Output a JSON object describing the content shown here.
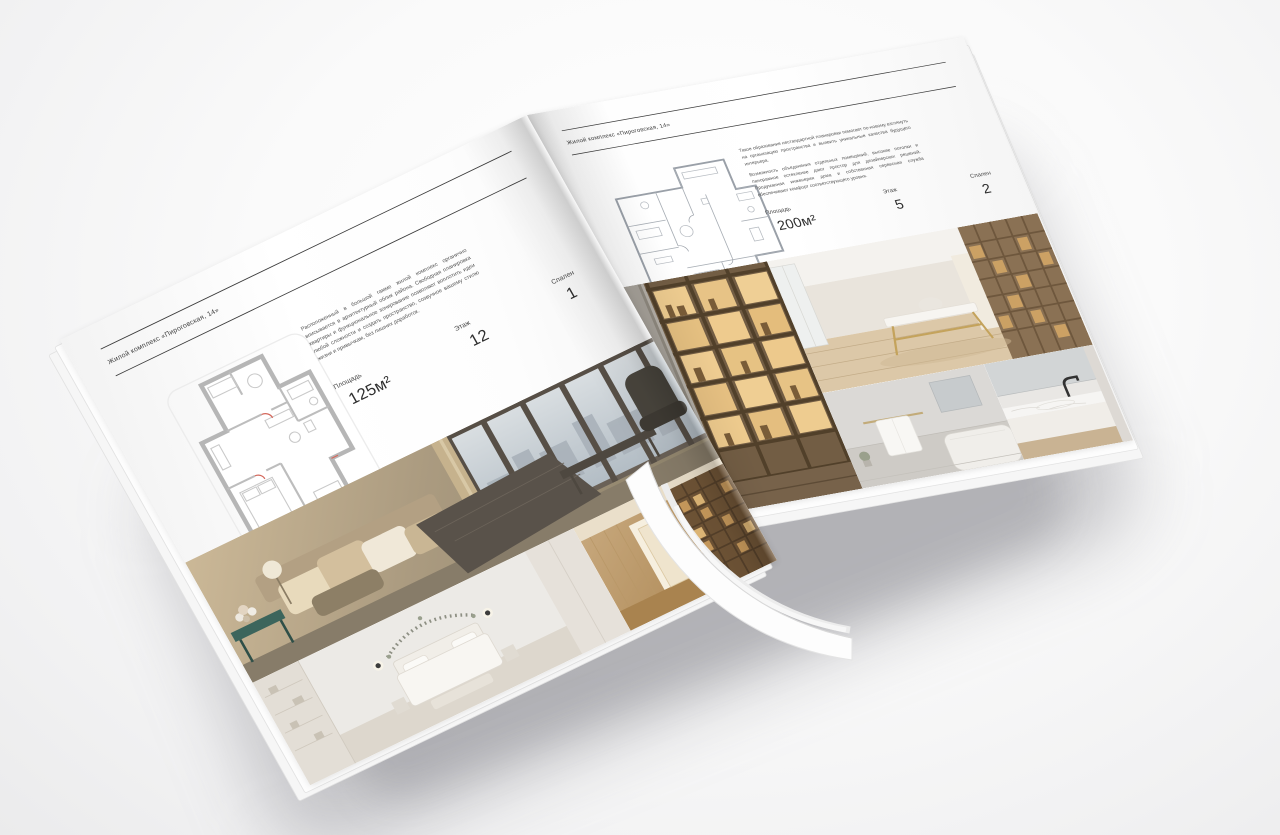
{
  "colors": {
    "background": "#f1f1f2",
    "paper": "#ffffff",
    "ink": "#3a3a3a"
  },
  "brochure": {
    "left_page": {
      "header": "Жилой комплекс «Пироговская, 14»",
      "description": "Расположенный в большой гамме жилой комплекс органично вписывается в архитектурный облик района. Свободная планировка квартиры и функциональное зонирование позволяют воплотить идеи любой сложности и создать пространство, созвучное вашему стилю жизни и привычкам, без лишних доработок.",
      "stats": [
        {
          "label": "Площадь",
          "value": "125м²"
        },
        {
          "label": "Этаж",
          "value": "12"
        },
        {
          "label": "Спален",
          "value": "1"
        }
      ]
    },
    "right_page": {
      "header": "Жилой комплекс «Пироговская, 14»",
      "description_p1": "Такое образование нестандартной планировки помогает по-новому взглянуть на организацию пространства и выявить уникальные качества будущего интерьера.",
      "description_p2": "Возможность объединения отдельных помещений, высокие потолки и панорамное остекление дают простор для дизайнерских решений. Продуманная инженерия дома и собственная сервисная служба обеспечивают комфорт соответствующего уровня.",
      "stats": [
        {
          "label": "Площадь",
          "value": "200м²"
        },
        {
          "label": "Этаж",
          "value": "5"
        },
        {
          "label": "Спален",
          "value": "2"
        }
      ]
    }
  }
}
